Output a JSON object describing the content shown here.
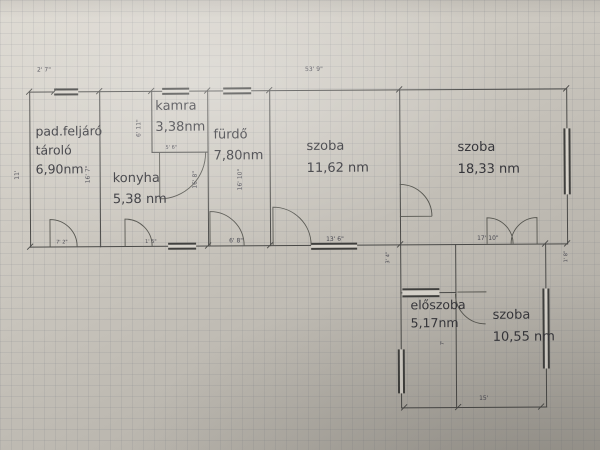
{
  "title": "floor-plan-photo",
  "rooms": [
    {
      "line1": "pad.feljáró",
      "line2": "tároló",
      "area": "6,90nm"
    },
    {
      "line1": "kamra",
      "area": "3,38nm"
    },
    {
      "line1": "konyha",
      "area": "5,38 nm"
    },
    {
      "line1": "fürdő",
      "area": "7,80nm"
    },
    {
      "line1": "szoba",
      "area": "11,62 nm"
    },
    {
      "line1": "szoba",
      "area": "18,33 nm"
    },
    {
      "line1": "előszoba",
      "area": "5,17nm"
    },
    {
      "line1": "szoba",
      "area": "10,55 nm"
    }
  ],
  "dimensions": {
    "top_small": "2' 7\"",
    "top_total": "53' 9\"",
    "left_height": "11'",
    "tarolo_right": "16' 7\"",
    "tarolo_door": "7' 2\"",
    "kamra_left": "6' 11\"",
    "kamra_bottom": "5' 6\"",
    "furdo_left": "16' 8\"",
    "furdo_right": "16' 10\"",
    "furdo_bottom": "6' 8\"",
    "konyha_door": "1' 5\"",
    "szoba1_bottom": "13' 6\"",
    "szoba2_bottom": "17' 10\"",
    "right_stub": "1' 8\"",
    "lower_left_small": "3' 4\"",
    "eloszoba_small": "7'",
    "bottom_total": "15'"
  },
  "colors": {
    "line": "#4a4a48",
    "paper_light": "#dcd8d0",
    "paper_dark": "#a7a39b"
  }
}
